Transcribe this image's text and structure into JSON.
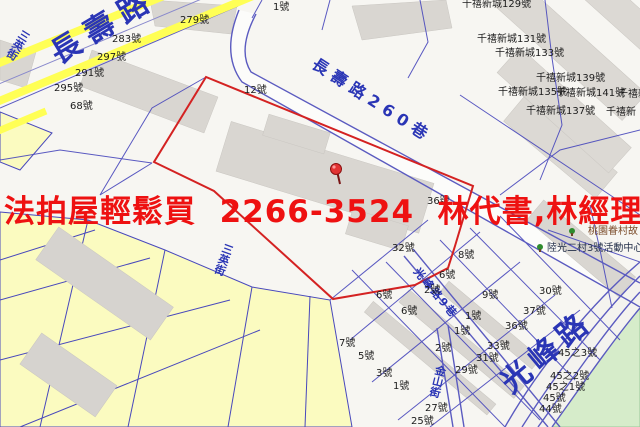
{
  "ad": {
    "text": "法拍屋輕鬆買  2266-3524  林代書,林經理",
    "color": "#ee1111"
  },
  "map": {
    "colors": {
      "ad_red": "#ee1111",
      "parcel_outline_red": "#d42222",
      "street_label_blue": "#2a35b5",
      "road_yellow": "#ffff55",
      "parcel_yellow": "#fbfbc0",
      "green_area": "#d6ecca",
      "building_gray": "#d9d6d1",
      "cadastral_line_blue": "#4848bc"
    },
    "pin": {
      "x": 336,
      "y": 169
    },
    "labels": [
      {
        "name": "street-label-changshou-rd",
        "t": "長壽路",
        "x": 46,
        "y": 44,
        "rot": -31,
        "size": 30,
        "ls": 9,
        "cls": "street"
      },
      {
        "name": "street-label-changshou-260-lane",
        "t": "長壽路260巷",
        "x": 318,
        "y": 56,
        "rot": 33,
        "size": 16,
        "ls": 6,
        "cls": "street"
      },
      {
        "name": "street-label-guangfeng-rd",
        "t": "光峰路",
        "x": 496,
        "y": 376,
        "rot": -40,
        "size": 30,
        "ls": 6,
        "cls": "street"
      },
      {
        "name": "street-label-jinshan-st",
        "t": "金山街",
        "x": 436,
        "y": 364,
        "rot": 14,
        "size": 11,
        "cls": "street v"
      },
      {
        "name": "street-label-sanying-st",
        "t": "三英街",
        "x": 22,
        "y": 28,
        "rot": 32,
        "size": 11,
        "cls": "street v"
      },
      {
        "name": "street-label-sanying-st",
        "t": "三英街",
        "x": 224,
        "y": 242,
        "rot": 20,
        "size": 11,
        "cls": "street v"
      },
      {
        "name": "street-label-lane-9",
        "t": "光峰路9巷",
        "x": 420,
        "y": 266,
        "rot": 50,
        "size": 11,
        "ls": 2,
        "cls": "street"
      },
      {
        "name": "poi-label-military-village",
        "t": "桃園眷村故",
        "x": 588,
        "y": 227,
        "size": 10,
        "cls": "poi brown"
      },
      {
        "name": "poi-label-activity-center",
        "t": "陸光二村3號活動中心",
        "x": 547,
        "y": 244,
        "size": 10,
        "cls": "poi"
      },
      {
        "t": "279號",
        "x": 180,
        "y": 16
      },
      {
        "t": "1號",
        "x": 273,
        "y": 3
      },
      {
        "t": "283號",
        "x": 112,
        "y": 35
      },
      {
        "t": "297號",
        "x": 97,
        "y": 53
      },
      {
        "t": "291號",
        "x": 75,
        "y": 69
      },
      {
        "t": "295號",
        "x": 54,
        "y": 84
      },
      {
        "t": "68號",
        "x": 70,
        "y": 102
      },
      {
        "t": "12號",
        "x": 244,
        "y": 86
      },
      {
        "t": "千禧新城129號",
        "x": 462,
        "y": 0
      },
      {
        "t": "千禧新城131號",
        "x": 477,
        "y": 35
      },
      {
        "t": "千禧新城133號",
        "x": 495,
        "y": 49
      },
      {
        "t": "千禧新城139號",
        "x": 536,
        "y": 74
      },
      {
        "t": "千禧新城135號",
        "x": 498,
        "y": 88
      },
      {
        "t": "千禧新城141號",
        "x": 556,
        "y": 89
      },
      {
        "t": "千禧新",
        "x": 618,
        "y": 90
      },
      {
        "t": "千禧新城137號",
        "x": 526,
        "y": 107
      },
      {
        "t": "千禧新",
        "x": 606,
        "y": 108
      },
      {
        "t": "36號",
        "x": 427,
        "y": 197
      },
      {
        "t": "32號",
        "x": 392,
        "y": 244
      },
      {
        "t": "8號",
        "x": 458,
        "y": 251
      },
      {
        "t": "6號",
        "x": 439,
        "y": 271
      },
      {
        "t": "2號",
        "x": 424,
        "y": 286
      },
      {
        "t": "9號",
        "x": 482,
        "y": 291
      },
      {
        "t": "6號",
        "x": 376,
        "y": 291
      },
      {
        "t": "6號",
        "x": 401,
        "y": 307
      },
      {
        "t": "1號",
        "x": 465,
        "y": 312
      },
      {
        "t": "1號",
        "x": 454,
        "y": 327
      },
      {
        "t": "2號",
        "x": 435,
        "y": 344
      },
      {
        "t": "33號",
        "x": 487,
        "y": 342
      },
      {
        "t": "31號",
        "x": 476,
        "y": 354
      },
      {
        "t": "29號",
        "x": 455,
        "y": 366
      },
      {
        "t": "30號",
        "x": 539,
        "y": 287
      },
      {
        "t": "7號",
        "x": 339,
        "y": 339
      },
      {
        "t": "5號",
        "x": 358,
        "y": 352
      },
      {
        "t": "3號",
        "x": 376,
        "y": 369
      },
      {
        "t": "1號",
        "x": 393,
        "y": 382
      },
      {
        "t": "27號",
        "x": 425,
        "y": 404
      },
      {
        "t": "25號",
        "x": 411,
        "y": 417
      },
      {
        "t": "37號",
        "x": 523,
        "y": 307
      },
      {
        "t": "36號",
        "x": 505,
        "y": 322
      },
      {
        "t": "45之3號",
        "x": 558,
        "y": 349
      },
      {
        "t": "45之2號",
        "x": 550,
        "y": 372
      },
      {
        "t": "45之1號",
        "x": 546,
        "y": 383
      },
      {
        "t": "45號",
        "x": 543,
        "y": 394
      },
      {
        "t": "44號",
        "x": 539,
        "y": 405
      }
    ]
  }
}
